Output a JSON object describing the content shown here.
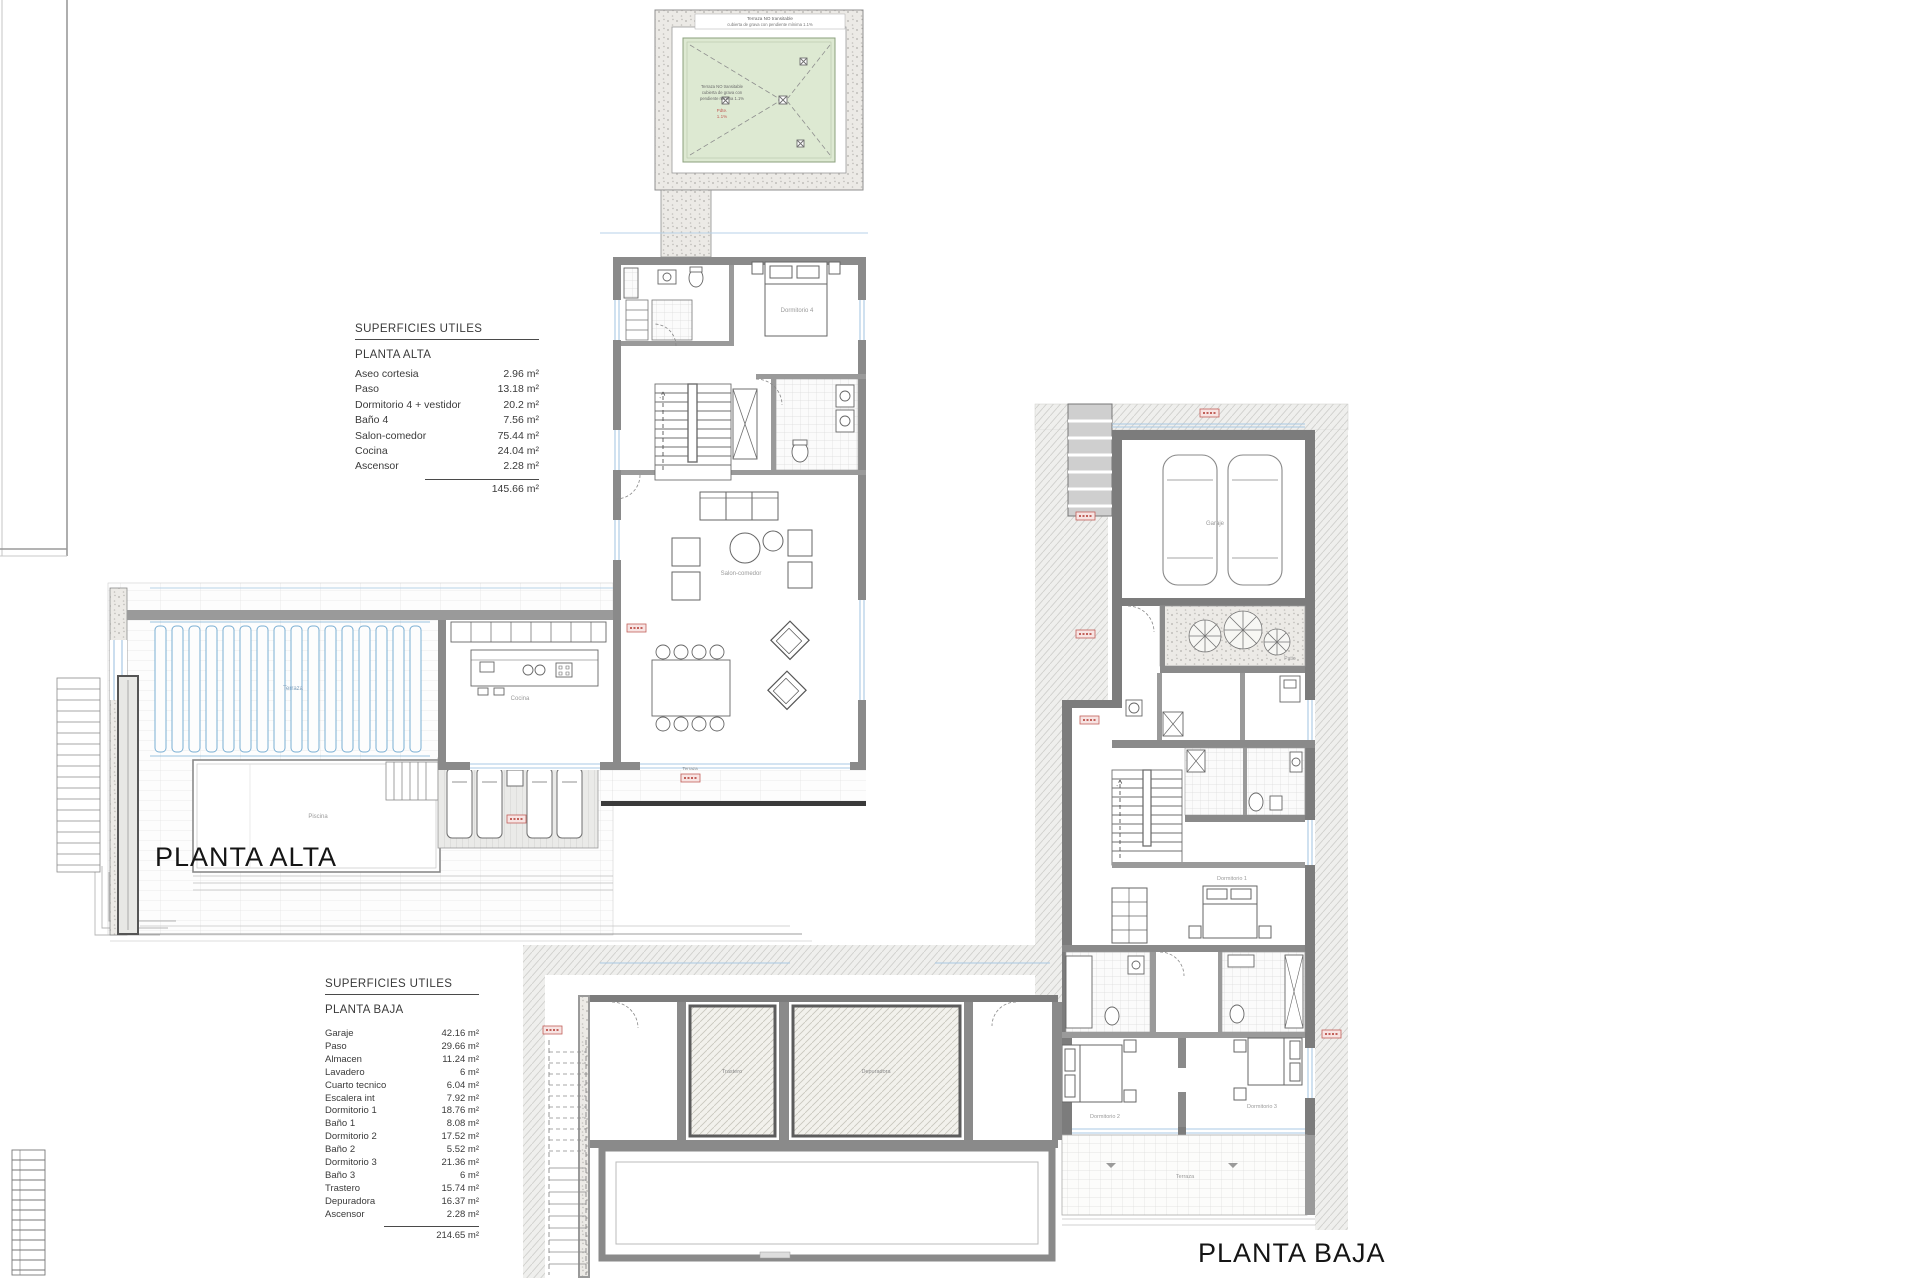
{
  "titles": {
    "planta_alta": "PLANTA ALTA",
    "planta_baja": "PLANTA BAJA"
  },
  "tables": {
    "alta": {
      "header": "SUPERFICIES UTILES",
      "floor": "PLANTA ALTA",
      "rows": [
        {
          "label": "Aseo cortesia",
          "value": "2.96 m²"
        },
        {
          "label": "Paso",
          "value": "13.18 m²"
        },
        {
          "label": "Dormitorio 4 + vestidor",
          "value": "20.2 m²"
        },
        {
          "label": "Baño 4",
          "value": "7.56 m²"
        },
        {
          "label": "Salon-comedor",
          "value": "75.44 m²"
        },
        {
          "label": "Cocina",
          "value": "24.04 m²"
        },
        {
          "label": "Ascensor",
          "value": "2.28 m²"
        }
      ],
      "total": "145.66 m²"
    },
    "baja": {
      "header": "SUPERFICIES UTILES",
      "floor": "PLANTA BAJA",
      "rows": [
        {
          "label": "Garaje",
          "value": "42.16 m²"
        },
        {
          "label": "Paso",
          "value": "29.66 m²"
        },
        {
          "label": "Almacen",
          "value": "11.24 m²"
        },
        {
          "label": "Lavadero",
          "value": "6 m²"
        },
        {
          "label": "Cuarto tecnico",
          "value": "6.04 m²"
        },
        {
          "label": "Escalera int",
          "value": "7.92 m²"
        },
        {
          "label": "Dormitorio 1",
          "value": "18.76 m²"
        },
        {
          "label": "Baño 1",
          "value": "8.08 m²"
        },
        {
          "label": "Dormitorio 2",
          "value": "17.52 m²"
        },
        {
          "label": "Baño 2",
          "value": "5.52 m²"
        },
        {
          "label": "Dormitorio 3",
          "value": "21.36 m²"
        },
        {
          "label": "Baño 3",
          "value": "6 m²"
        },
        {
          "label": "Trastero",
          "value": "15.74 m²"
        },
        {
          "label": "Depuradora",
          "value": "16.37 m²"
        },
        {
          "label": "Ascensor",
          "value": "2.28 m²"
        }
      ],
      "total": "214.65 m²"
    }
  },
  "roof_detail": {
    "banner1": "Terraza NO transitable",
    "banner2": "cubierta de grava con pendiente mínima 1.1%",
    "note1": "Terraza NO transitable",
    "note2": "cubierta de grava con",
    "note3": "pendiente mínima 1.1%",
    "red1": "Pdte.",
    "red2": "1.1%"
  },
  "room_labels": {
    "dormitorio4": "Dormitorio 4",
    "bano4": "Baño 4",
    "salon": "Salon-comedor",
    "cocina": "Cocina",
    "terraza_alta": "Terraza",
    "piscina": "Piscina",
    "terraza_sur": "Terraza",
    "garaje": "Garaje",
    "patio": "Patio",
    "dormitorio1": "Dormitorio 1",
    "dormitorio2": "Dormitorio 2",
    "dormitorio3": "Dormitorio 3",
    "terraza_baja": "Terraza",
    "trastero": "Trastero",
    "depuradora": "Depuradora"
  },
  "colors": {
    "wall": "#8a8a8a",
    "wall_dark": "#3a3a3a",
    "glass_blue": "#a8c8e4",
    "pergola_blue": "#79aed3",
    "roof_green": "#dde9d2",
    "tag_red": "#c2605a"
  }
}
